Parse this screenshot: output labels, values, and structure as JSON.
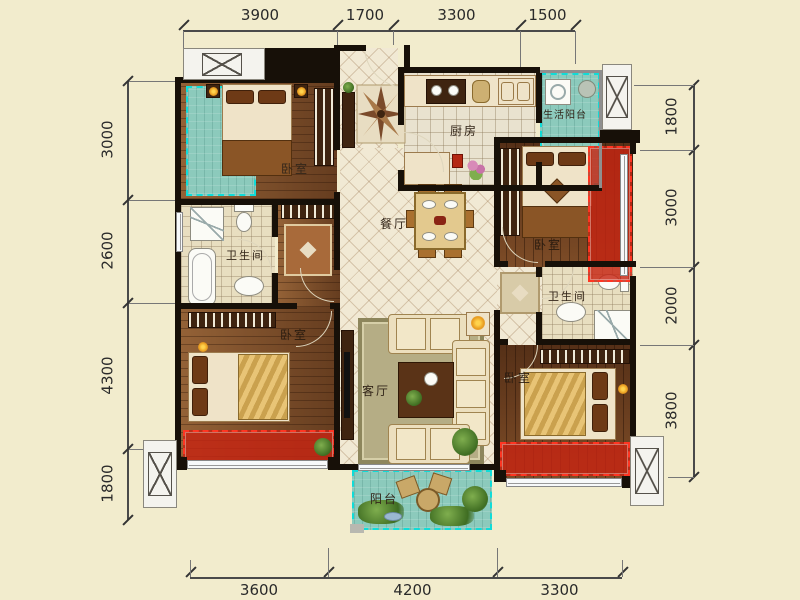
{
  "title": "三室两厅户型图",
  "colors": {
    "background": "#f2eccd",
    "wall": "#171008",
    "balcony_teal": "#8ccabc",
    "overlay_cyan_dash": "#10dcd8",
    "overlay_red": "#c62412",
    "overlay_red_dash": "#ff3522",
    "dimension_text": "#2a2a2a"
  },
  "rooms": {
    "bedroom_top_left": "卧室",
    "bedroom_top_right": "卧室",
    "bedroom_bottom_left": "卧室",
    "bedroom_bottom_right": "卧室",
    "kitchen": "厨房",
    "dining": "餐厅",
    "living": "客厅",
    "bath_left": "卫生间",
    "bath_right": "卫生间",
    "service_balcony": "生活阳台",
    "balcony": "阳台"
  },
  "dims": {
    "top": [
      "3900",
      "1700",
      "3300",
      "1500"
    ],
    "bottom": [
      "3600",
      "4200",
      "3300"
    ],
    "left": [
      "3000",
      "2600",
      "4300",
      "1800"
    ],
    "right": [
      "1800",
      "3000",
      "2000",
      "3800"
    ]
  }
}
